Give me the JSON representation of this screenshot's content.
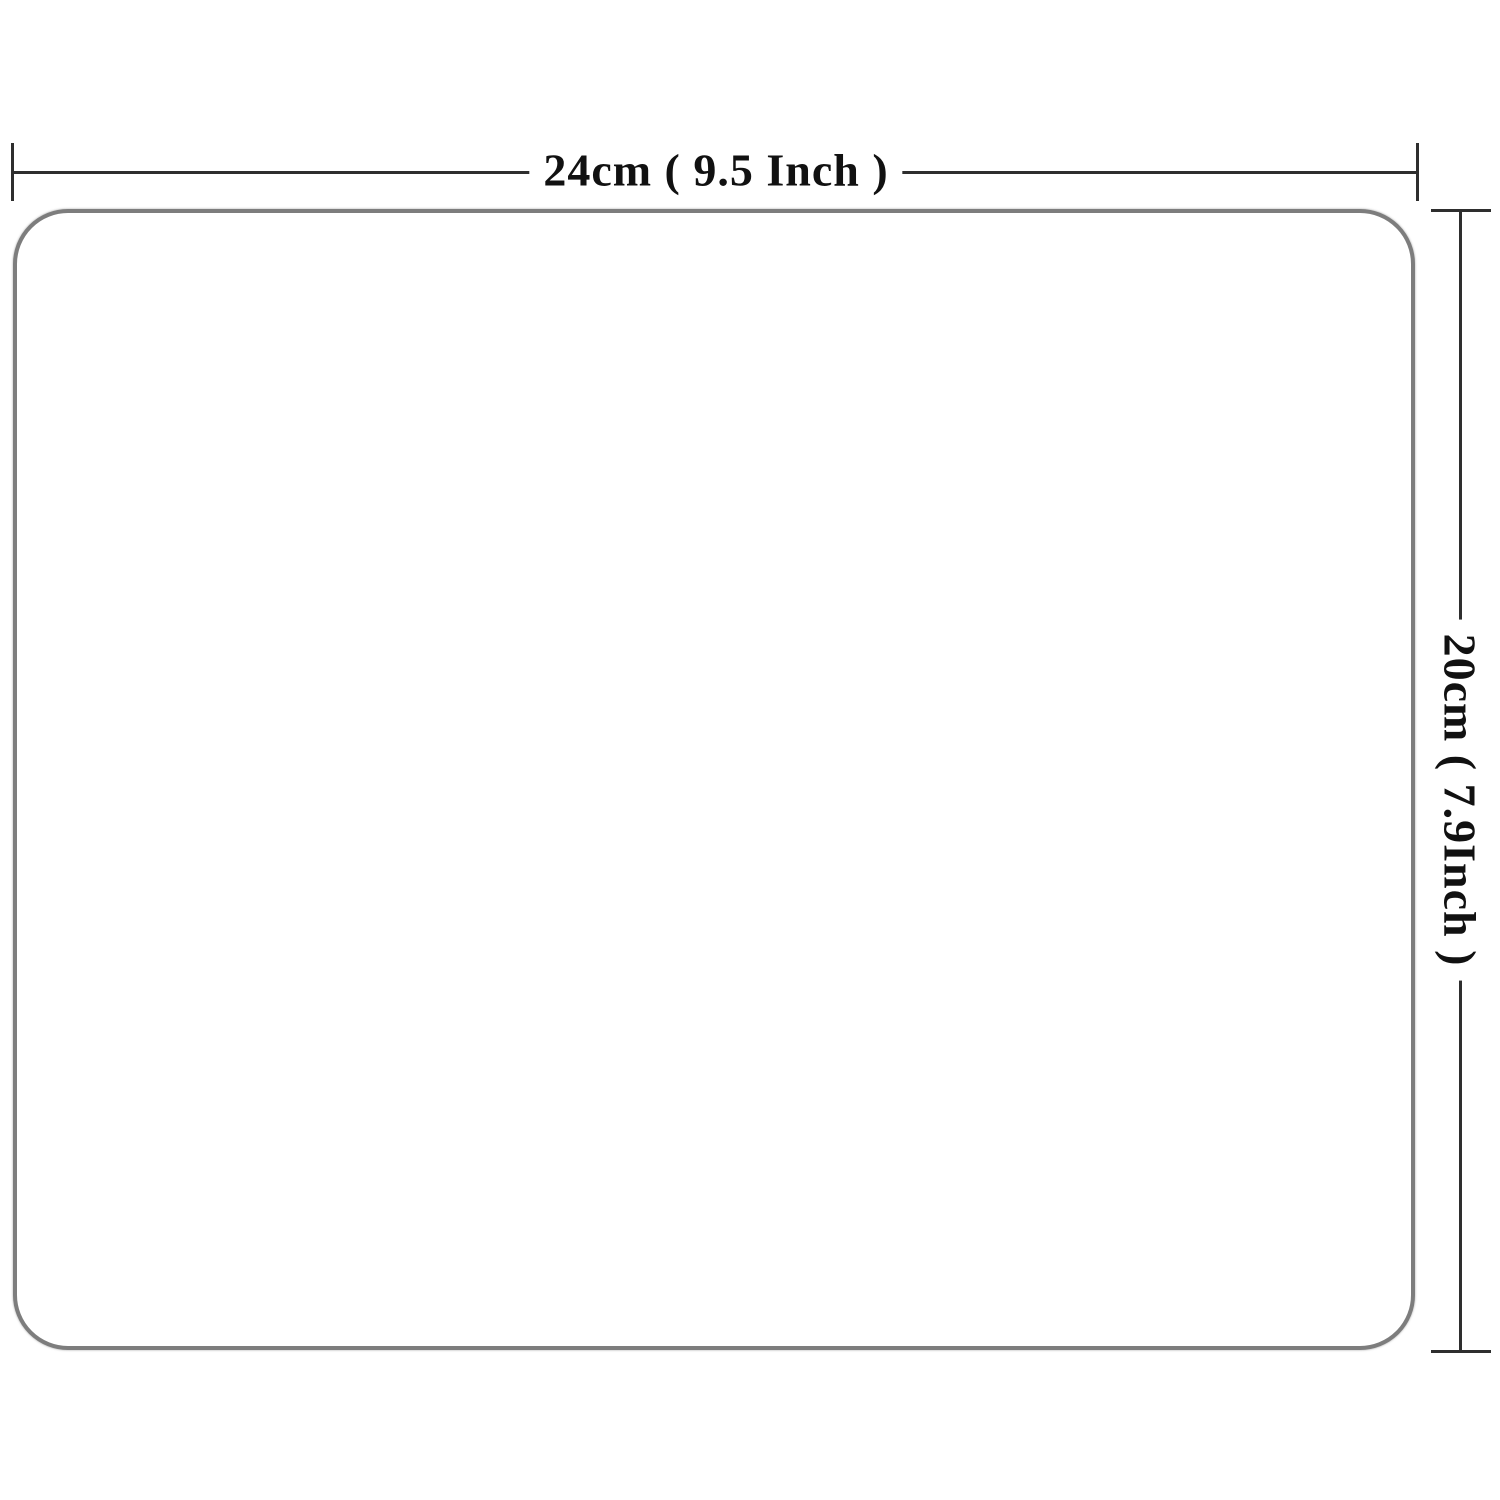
{
  "diagram": {
    "type": "product-dimension-diagram",
    "shape": "rounded-rectangle",
    "width_dimension": {
      "label": "24cm ( 9.5  Inch )"
    },
    "height_dimension": {
      "label": "20cm ( 7.9Inch )"
    },
    "colors": {
      "dimension_line": "#2e2e2e",
      "label_text": "#111111",
      "outline_border": "#7d7d7d",
      "fill": "#ffffff"
    }
  }
}
